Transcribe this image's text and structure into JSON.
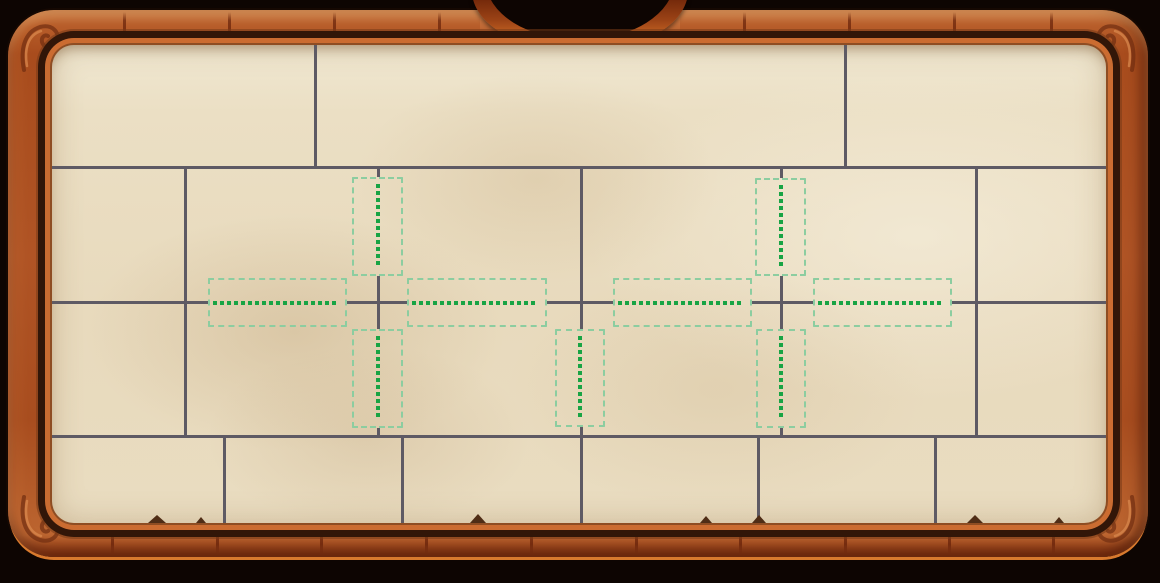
{
  "app": {
    "description": "wooden-framed parchment puzzle board with plank grid and green placement hint slots",
    "visible_text": []
  },
  "colors": {
    "page_bg": "#0d0502",
    "wood_base": "#b05425",
    "frame_edge_glow": "#d87a2e",
    "rim_bright": "#cb6c31",
    "rim_dark": "#321608",
    "parchment": "#e9dcc2",
    "grid_line": "#5e5a64",
    "slot_border": "#8ccda0",
    "slot_dot": "#18a444",
    "seam": "#601c06",
    "nick": "#4f2d16"
  },
  "frame": {
    "top_seams": [
      115,
      220,
      325,
      430,
      735,
      840,
      945,
      1042
    ],
    "bottom_seams": [
      103,
      208,
      312,
      417,
      522,
      627,
      731,
      836,
      940,
      1044
    ],
    "notch": {
      "left_cap_x": 480,
      "right_cap_x": 662
    }
  },
  "board": {
    "grid": {
      "h_lines": [
        {
          "x1": 0,
          "x2": 1054,
          "y": 122
        },
        {
          "x1": 0,
          "x2": 156,
          "y": 257
        },
        {
          "x1": 295,
          "x2": 355,
          "y": 257
        },
        {
          "x1": 495,
          "x2": 561,
          "y": 257
        },
        {
          "x1": 700,
          "x2": 761,
          "y": 257
        },
        {
          "x1": 900,
          "x2": 1054,
          "y": 257
        },
        {
          "x1": 0,
          "x2": 1054,
          "y": 391
        }
      ],
      "v_lines": [
        {
          "x": 263,
          "y1": 0,
          "y2": 122
        },
        {
          "x": 793,
          "y1": 0,
          "y2": 122
        },
        {
          "x": 133,
          "y1": 122,
          "y2": 391
        },
        {
          "x": 924,
          "y1": 122,
          "y2": 391
        },
        {
          "x": 326,
          "y1": 122,
          "y2": 132
        },
        {
          "x": 326,
          "y1": 231,
          "y2": 284
        },
        {
          "x": 326,
          "y1": 383,
          "y2": 391
        },
        {
          "x": 729,
          "y1": 122,
          "y2": 133
        },
        {
          "x": 729,
          "y1": 231,
          "y2": 284
        },
        {
          "x": 729,
          "y1": 383,
          "y2": 391
        },
        {
          "x": 529,
          "y1": 122,
          "y2": 284
        },
        {
          "x": 529,
          "y1": 382,
          "y2": 478
        },
        {
          "x": 172,
          "y1": 391,
          "y2": 478
        },
        {
          "x": 350,
          "y1": 391,
          "y2": 478
        },
        {
          "x": 706,
          "y1": 391,
          "y2": 478
        },
        {
          "x": 883,
          "y1": 391,
          "y2": 478
        }
      ]
    },
    "slots": [
      {
        "id": "left-cross-up",
        "orientation": "vertical",
        "x": 300,
        "y": 132,
        "w": 51,
        "h": 99
      },
      {
        "id": "left-cross-left",
        "orientation": "horizontal",
        "x": 156,
        "y": 233,
        "w": 139,
        "h": 49
      },
      {
        "id": "left-cross-right",
        "orientation": "horizontal",
        "x": 355,
        "y": 233,
        "w": 140,
        "h": 49
      },
      {
        "id": "left-cross-down",
        "orientation": "vertical",
        "x": 300,
        "y": 284,
        "w": 51,
        "h": 99
      },
      {
        "id": "right-cross-up",
        "orientation": "vertical",
        "x": 703,
        "y": 133,
        "w": 51,
        "h": 98
      },
      {
        "id": "right-cross-left",
        "orientation": "horizontal",
        "x": 561,
        "y": 233,
        "w": 139,
        "h": 49
      },
      {
        "id": "right-cross-right",
        "orientation": "horizontal",
        "x": 761,
        "y": 233,
        "w": 139,
        "h": 49
      },
      {
        "id": "right-cross-down",
        "orientation": "vertical",
        "x": 704,
        "y": 284,
        "w": 50,
        "h": 99
      },
      {
        "id": "middle-down",
        "orientation": "vertical",
        "x": 503,
        "y": 284,
        "w": 50,
        "h": 98
      }
    ],
    "torn_nicks": [
      {
        "x": 96,
        "w": 18,
        "h": 8
      },
      {
        "x": 144,
        "w": 10,
        "h": 6
      },
      {
        "x": 418,
        "w": 16,
        "h": 9
      },
      {
        "x": 648,
        "w": 12,
        "h": 7
      },
      {
        "x": 700,
        "w": 14,
        "h": 8
      },
      {
        "x": 915,
        "w": 16,
        "h": 8
      },
      {
        "x": 1002,
        "w": 10,
        "h": 6
      }
    ]
  }
}
